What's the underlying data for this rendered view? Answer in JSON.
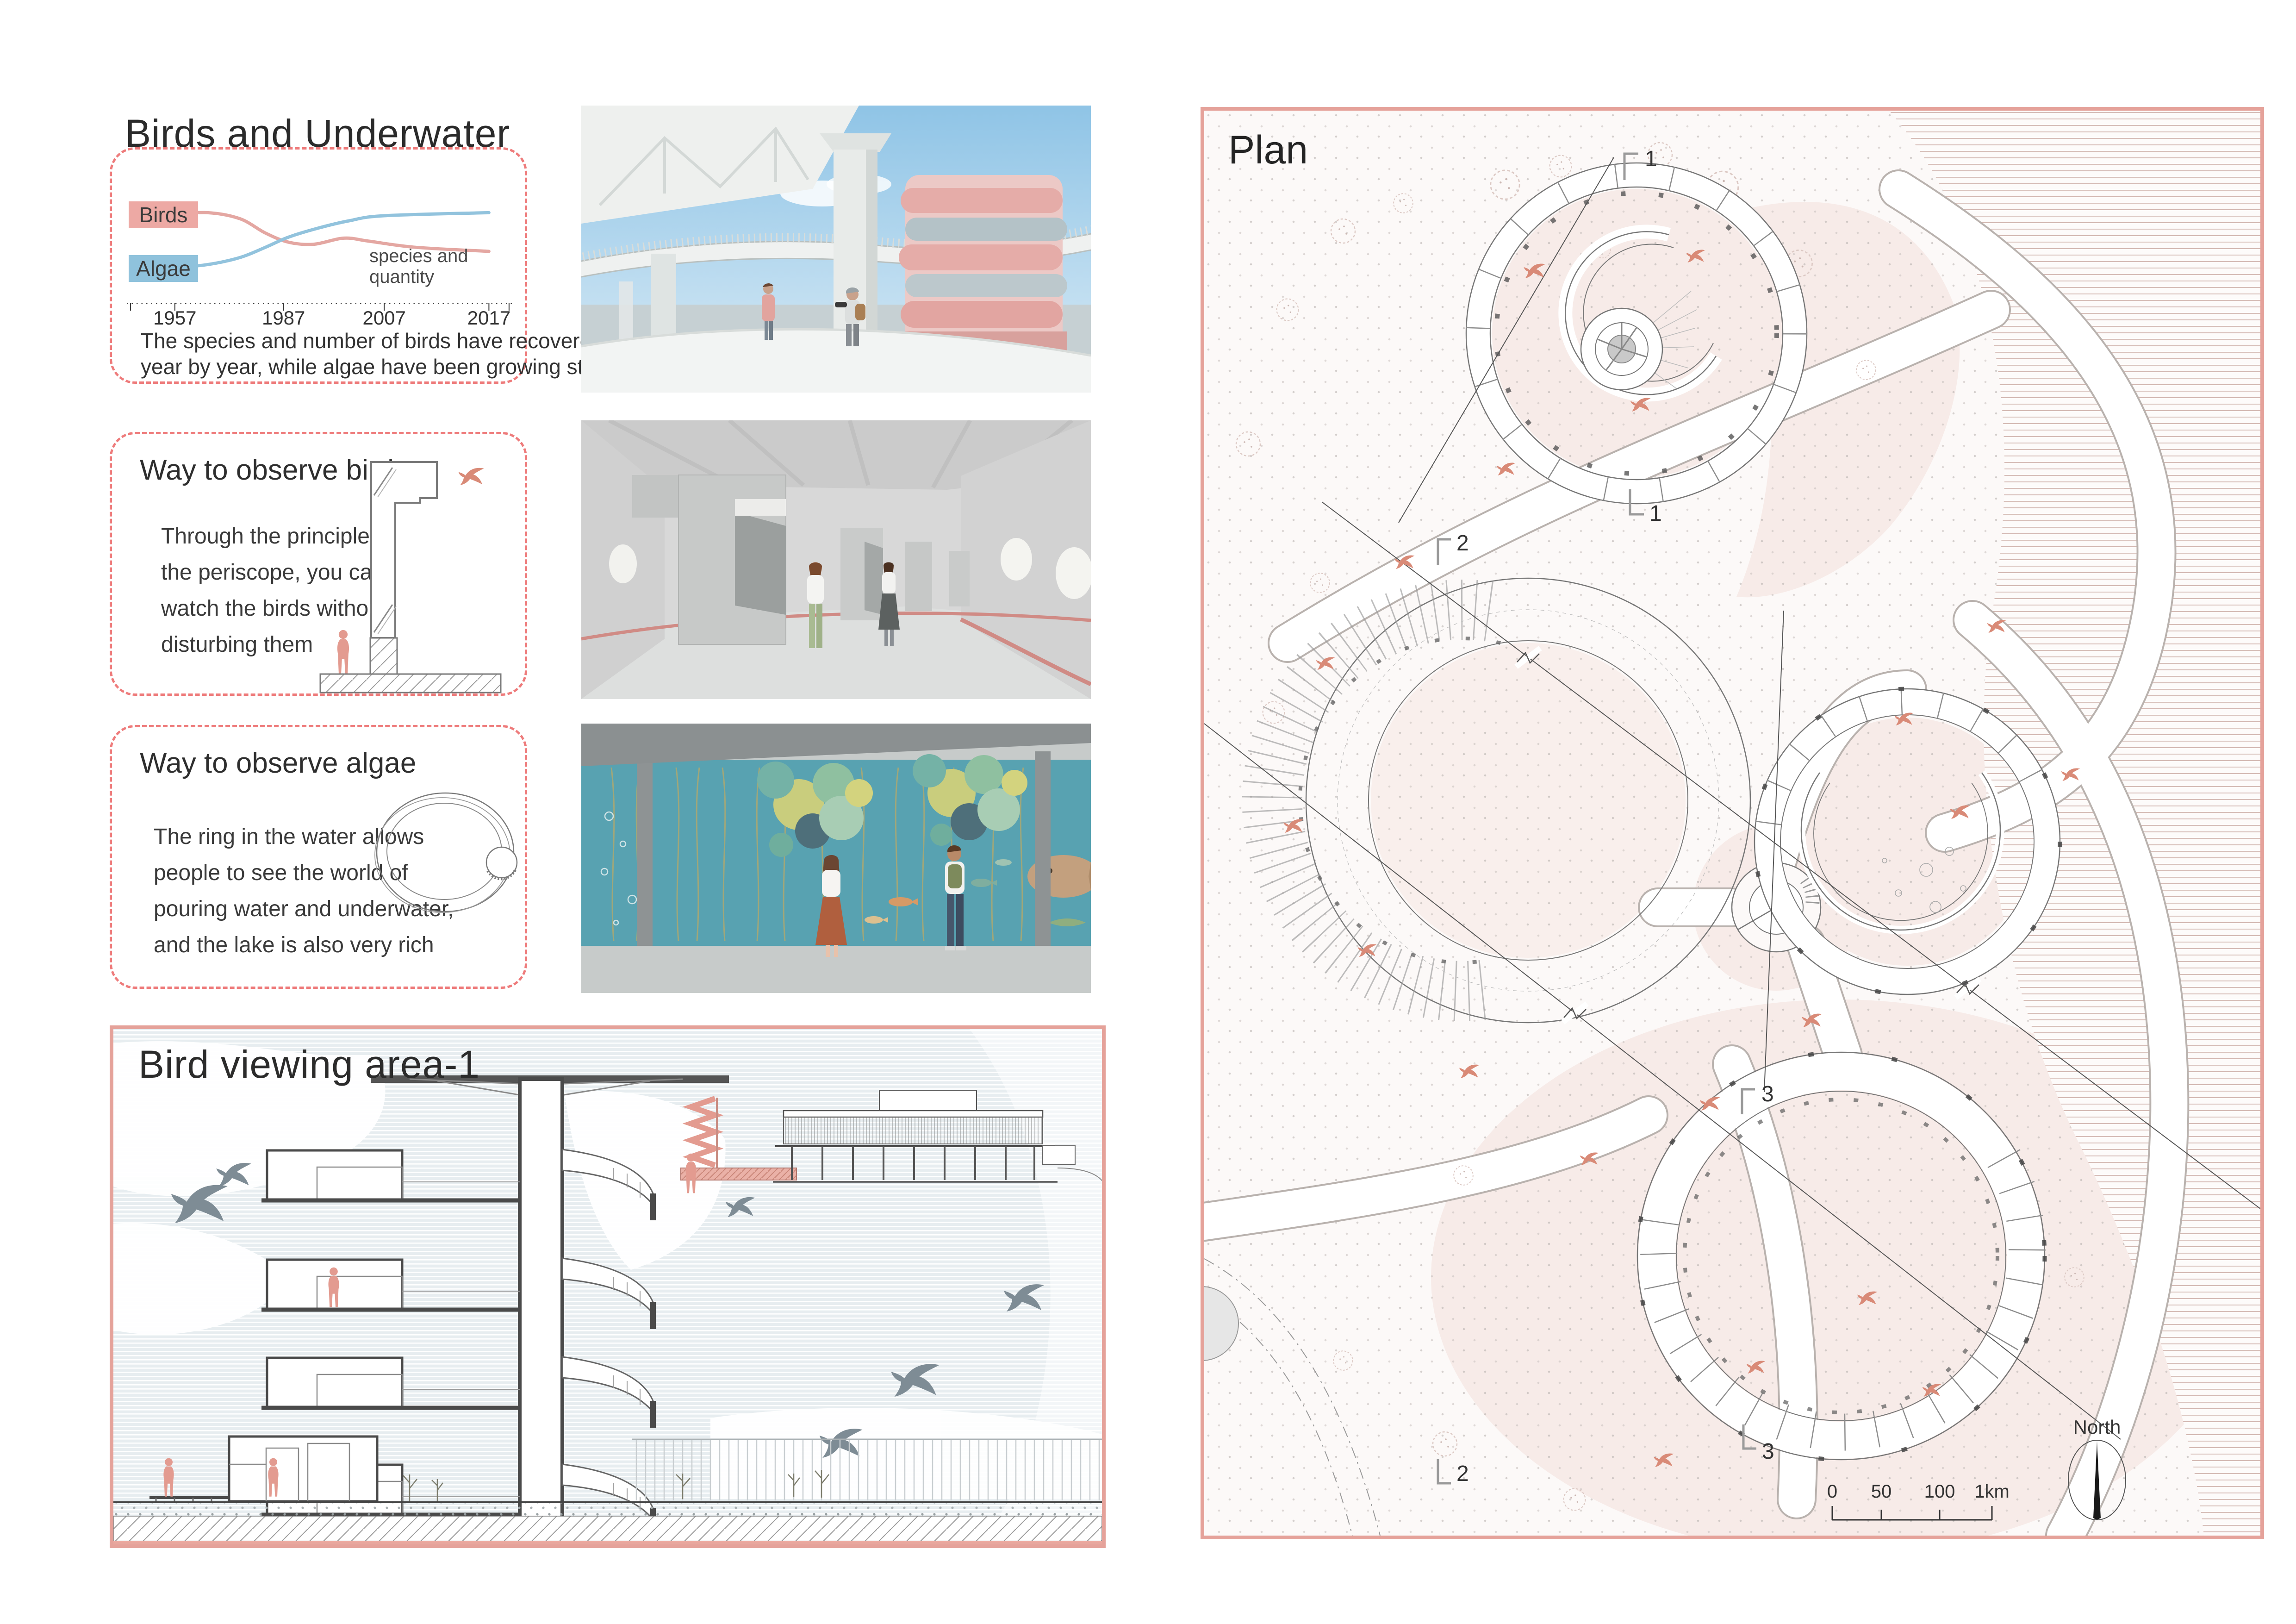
{
  "colors": {
    "accent_salmon": "#e5a29a",
    "dashed_border": "#ee7b7b",
    "birds_line": "#e4a7a2",
    "algae_line": "#92c3dd",
    "plan_bird": "#d98a77",
    "section_bird": "#7e8c95"
  },
  "birds_underwater": {
    "title": "Birds and Underwater",
    "legend": {
      "birds": "Birds",
      "algae": "Algae"
    },
    "annotation": "species and quantity",
    "caption": [
      "The species and number of birds have recovered",
      "year by year, while algae have been growing steadily"
    ]
  },
  "chart_data": {
    "type": "line",
    "title": "Birds and Underwater",
    "x_labels": [
      "1957",
      "1987",
      "2007",
      "2017"
    ],
    "x_tick_years": [
      1957,
      1987,
      2007,
      2017
    ],
    "tick_fractions": [
      0.14,
      0.41,
      0.66,
      0.92
    ],
    "ylim": [
      0,
      100
    ],
    "grid": false,
    "legend_position": "left",
    "series": [
      {
        "name": "Birds",
        "color": "#e4a7a2",
        "points": [
          [
            1957,
            76
          ],
          [
            1966,
            78
          ],
          [
            1975,
            72
          ],
          [
            1982,
            58
          ],
          [
            1988,
            49
          ],
          [
            1993,
            47
          ],
          [
            1999,
            53
          ],
          [
            2004,
            50
          ],
          [
            2010,
            44
          ],
          [
            2017,
            40
          ]
        ]
      },
      {
        "name": "Algae",
        "color": "#92c3dd",
        "points": [
          [
            1957,
            24
          ],
          [
            1966,
            27
          ],
          [
            1975,
            34
          ],
          [
            1982,
            44
          ],
          [
            1988,
            54
          ],
          [
            1994,
            63
          ],
          [
            2000,
            70
          ],
          [
            2007,
            75
          ],
          [
            2017,
            78
          ]
        ]
      }
    ]
  },
  "observe_birds": {
    "title": "Way to observe birds",
    "body": [
      "Through the principle of",
      "the periscope, you can",
      "watch the birds without",
      "disturbing them"
    ]
  },
  "observe_algae": {
    "title": "Way to observe algae",
    "body": [
      "The ring in the water allows",
      "people to see the world of",
      "pouring water and underwater,",
      "and the lake is also very rich"
    ]
  },
  "bird_viewing": {
    "title": "Bird viewing area-1"
  },
  "plan": {
    "title": "Plan",
    "markers": {
      "m1a": "1",
      "m1b": "1",
      "m2a": "2",
      "m2b": "2",
      "m3a": "3",
      "m3b": "3"
    },
    "north_label": "North",
    "scale": {
      "t0": "0",
      "t1": "50",
      "t2": "100",
      "t3": "1km"
    }
  }
}
